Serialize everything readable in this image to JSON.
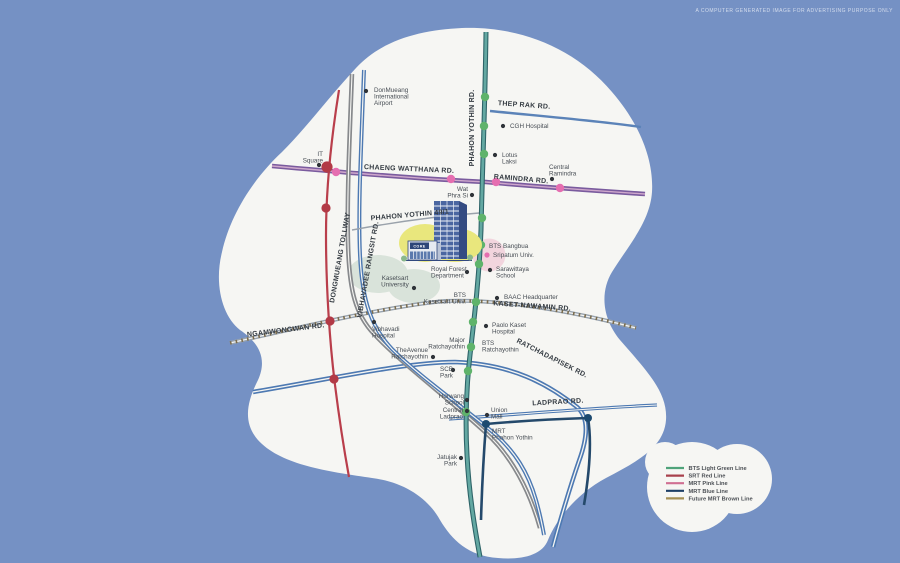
{
  "disclaimer": "A COMPUTER GENERATED IMAGE FOR ADVERTISING PURPOSE ONLY",
  "building": {
    "sign": "CORE"
  },
  "colors": {
    "background": "#7591c4",
    "map_fill": "#f6f6f3",
    "bts_green_line": "#2e6468",
    "bts_green_fill": "#63a8a2",
    "srt_red": "#b93e4b",
    "mrt_pink_road": "#7a5b9e",
    "mrt_blue": "#24496b",
    "mrt_brown": "#7b6c4d",
    "road_blue": "#4d79b2",
    "tollway_gray": "#87898c",
    "station_green": "#5fb36b",
    "station_red": "#b23a46",
    "station_pink": "#e56eb0",
    "station_navy": "#1d4a70",
    "station_gray": "#85a3ab",
    "landmark_dot": "#2f3338"
  },
  "map": {
    "road_labels": [
      {
        "id": "chaeng-watthana",
        "text": "CHAENG WATTHANA RD.",
        "x": 409,
        "y": 171,
        "rotate": 2.5
      },
      {
        "id": "ramindra",
        "text": "RAMINDRA RD.",
        "x": 521,
        "y": 181,
        "rotate": 5
      },
      {
        "id": "thep-rak",
        "text": "THEP RAK RD.",
        "x": 524,
        "y": 107,
        "rotate": 4
      },
      {
        "id": "phahon-yothin",
        "text": "PHAHON YOTHIN RD.",
        "x": 474,
        "y": 128,
        "rotate": -90
      },
      {
        "id": "phahon-yothin-49-1",
        "text": "PHAHON YOTHIN 49/1",
        "x": 410,
        "y": 217,
        "rotate": -5
      },
      {
        "id": "dongmueang-tollway",
        "text": "DONGMUEANG TOLLWAY",
        "x": 342,
        "y": 258,
        "rotate": -80
      },
      {
        "id": "vibhavadee-rangsit",
        "text": "VIBHAVADEE RANGSIT RD.",
        "x": 370,
        "y": 270,
        "rotate": -80
      },
      {
        "id": "ngamwongwan",
        "text": "NGAMWONGWAN RD.",
        "x": 286,
        "y": 332,
        "rotate": -7
      },
      {
        "id": "kaset-nawamin",
        "text": "KASET-NAWAMIN RD.",
        "x": 532,
        "y": 308,
        "rotate": 4
      },
      {
        "id": "ratchadapisek",
        "text": "RATCHADAPISEK RD.",
        "x": 551,
        "y": 360,
        "rotate": 27
      },
      {
        "id": "ladprao",
        "text": "LADPRAO RD.",
        "x": 558,
        "y": 404,
        "rotate": -3
      }
    ],
    "landmarks": [
      {
        "id": "donmueang-airport",
        "lines": [
          "DonMueang",
          "International",
          "Airport"
        ],
        "x": 374,
        "y": 92,
        "anchor": "start",
        "dot": [
          366,
          91
        ]
      },
      {
        "id": "it-square",
        "lines": [
          "IT",
          "Square"
        ],
        "x": 323,
        "y": 156,
        "anchor": "end",
        "dot": [
          319,
          165
        ]
      },
      {
        "id": "wat-phra-si",
        "lines": [
          "Wat",
          "Phra Si"
        ],
        "x": 468,
        "y": 191,
        "anchor": "end",
        "dot": [
          472,
          195
        ]
      },
      {
        "id": "cgh-hospital",
        "lines": [
          "CGH Hospital"
        ],
        "x": 510,
        "y": 128,
        "anchor": "start",
        "dot": [
          503,
          126
        ]
      },
      {
        "id": "lotus-laksi",
        "lines": [
          "Lotus",
          "Laksi"
        ],
        "x": 502,
        "y": 157,
        "anchor": "start",
        "dot": [
          495,
          155
        ]
      },
      {
        "id": "central-ramindra",
        "lines": [
          "Central",
          "Ramindra"
        ],
        "x": 549,
        "y": 169,
        "anchor": "start",
        "dot": [
          552,
          179
        ]
      },
      {
        "id": "bts-bangbua",
        "lines": [
          "BTS Bangbua"
        ],
        "x": 489,
        "y": 248,
        "anchor": "start",
        "dot": null
      },
      {
        "id": "sripatum-univ",
        "lines": [
          "Sripatum Univ."
        ],
        "x": 493,
        "y": 257,
        "anchor": "start",
        "dot": [
          487,
          255
        ],
        "dot_color": "#e56eb0",
        "tcolor": "#cb6570"
      },
      {
        "id": "royal-forest-department",
        "lines": [
          "Royal Forest",
          "Department"
        ],
        "x": 431,
        "y": 271,
        "anchor": "start",
        "dot": [
          467,
          272
        ]
      },
      {
        "id": "kasetsart-university",
        "lines": [
          "Kasetsart",
          "University"
        ],
        "x": 395,
        "y": 280,
        "anchor": "middle",
        "dot": [
          414,
          288
        ]
      },
      {
        "id": "bts-kasetsart-univ",
        "lines": [
          "BTS",
          "Kasetsart Univ."
        ],
        "x": 466,
        "y": 297,
        "anchor": "end",
        "dot": null
      },
      {
        "id": "sarawittaya-school",
        "lines": [
          "Sarawittaya",
          "School"
        ],
        "x": 496,
        "y": 271,
        "anchor": "start",
        "dot": [
          490,
          270
        ]
      },
      {
        "id": "baac-headquarter",
        "lines": [
          "BAAC Headquarter"
        ],
        "x": 504,
        "y": 299,
        "anchor": "start",
        "dot": [
          497,
          298
        ]
      },
      {
        "id": "vibhavadi-hospital",
        "lines": [
          "Vibhavadi",
          "Hospital"
        ],
        "x": 372,
        "y": 331,
        "anchor": "start",
        "dot": [
          374,
          322
        ]
      },
      {
        "id": "paolo-kaset-hospital",
        "lines": [
          "Paolo Kaset",
          "Hospital"
        ],
        "x": 492,
        "y": 327,
        "anchor": "start",
        "dot": [
          486,
          326
        ]
      },
      {
        "id": "major-ratchayothin",
        "lines": [
          "Major",
          "Ratchayothin"
        ],
        "x": 465,
        "y": 342,
        "anchor": "end",
        "dot": null
      },
      {
        "id": "bts-ratchayothin",
        "lines": [
          "BTS",
          "Ratchayothin"
        ],
        "x": 482,
        "y": 345,
        "anchor": "start",
        "dot": null
      },
      {
        "id": "theavenue-ratchayothin",
        "lines": [
          "TheAvenue",
          "Ratchayothin"
        ],
        "x": 428,
        "y": 352,
        "anchor": "end",
        "dot": [
          433,
          357
        ]
      },
      {
        "id": "scb-park",
        "lines": [
          "SCB",
          "Park"
        ],
        "x": 440,
        "y": 371,
        "anchor": "start",
        "dot": [
          453,
          370
        ]
      },
      {
        "id": "horwang-school",
        "lines": [
          "Horwang",
          "School"
        ],
        "x": 464,
        "y": 398,
        "anchor": "end",
        "dot": [
          467,
          400
        ]
      },
      {
        "id": "central-ladprao",
        "lines": [
          "Central",
          "Ladprao"
        ],
        "x": 463,
        "y": 412,
        "anchor": "end",
        "dot": [
          467,
          411
        ]
      },
      {
        "id": "union-mall",
        "lines": [
          "Union",
          "Mall"
        ],
        "x": 491,
        "y": 412,
        "anchor": "start",
        "dot": [
          487,
          415
        ]
      },
      {
        "id": "mrt-phahon-yothin",
        "lines": [
          "MRT",
          "Phahon Yothin"
        ],
        "x": 492,
        "y": 433,
        "anchor": "start",
        "dot": null
      },
      {
        "id": "jatujak-park",
        "lines": [
          "Jatujak",
          "Park"
        ],
        "x": 457,
        "y": 459,
        "anchor": "end",
        "dot": [
          461,
          458
        ]
      }
    ],
    "stations": {
      "green": [
        [
          485,
          97
        ],
        [
          484,
          126
        ],
        [
          484,
          154
        ],
        [
          482,
          218
        ],
        [
          481,
          245
        ],
        [
          479,
          264
        ],
        [
          476,
          302
        ],
        [
          473,
          322
        ],
        [
          471,
          347
        ],
        [
          468,
          371
        ],
        [
          466,
          412
        ]
      ],
      "red": [
        [
          327,
          167
        ],
        [
          326,
          208
        ],
        [
          330,
          321
        ],
        [
          334,
          379
        ]
      ],
      "pink": [
        [
          336,
          172
        ],
        [
          451,
          179
        ],
        [
          496,
          182
        ],
        [
          560,
          188
        ]
      ],
      "navy": [
        [
          486,
          424
        ],
        [
          588,
          418
        ]
      ],
      "gray": [
        [
          473,
          253
        ]
      ]
    }
  },
  "legend": {
    "items": [
      {
        "label": "BTS Light Green Line",
        "color": "#4fa37a"
      },
      {
        "label": "SRT Red Line",
        "color": "#a8414c"
      },
      {
        "label": "MRT Pink Line",
        "color": "#d06f92"
      },
      {
        "label": "MRT Blue Line",
        "color": "#1d3f66"
      },
      {
        "label": "Future MRT Brown Line",
        "color": "#a59055"
      }
    ]
  }
}
